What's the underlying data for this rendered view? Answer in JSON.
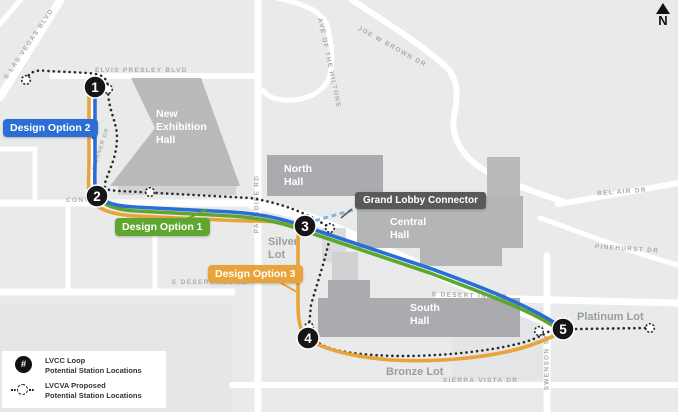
{
  "map": {
    "compass": "N",
    "streets": [
      "S LAS VEGAS BLVD",
      "ELVIS PRESLEY BLVD",
      "JOE W BROWN DR",
      "AVE OF THE HILTONS",
      "BEL AIR DR",
      "PINEHURST DR",
      "CONVENTION CENTER DR",
      "E DESERT INN RD",
      "E DESERT INN RD",
      "SIERRA VISTA DR",
      "PARADISE RD",
      "SWENSON ST",
      "KISHNER DR"
    ],
    "buildings": [
      "New Exhibition Hall",
      "North Hall",
      "Central Hall",
      "South Hall"
    ],
    "lots": [
      "Silver Lot",
      "Platinum Lot",
      "Bronze Lot"
    ],
    "stations": [
      "1",
      "2",
      "3",
      "4",
      "5"
    ],
    "badges": {
      "option1": "Design Option 1",
      "option2": "Design Option 2",
      "option3": "Design Option 3",
      "connector": "Grand Lobby Connector"
    },
    "colors": {
      "option1_green": "#5ea62e",
      "option2_blue": "#2b6fd6",
      "option3_orange": "#e8a43b",
      "lvcva_dotted": "#2a2a2a",
      "connector_dashed": "#8ab4e2",
      "station_black": "#161616"
    }
  },
  "legend": {
    "items": [
      {
        "symbol": "#",
        "line1": "LVCC Loop",
        "line2": "Potential Station Locations"
      },
      {
        "symbol": "dotted-circle",
        "line1": "LVCVA Proposed",
        "line2": "Potential Station Locations"
      }
    ]
  }
}
